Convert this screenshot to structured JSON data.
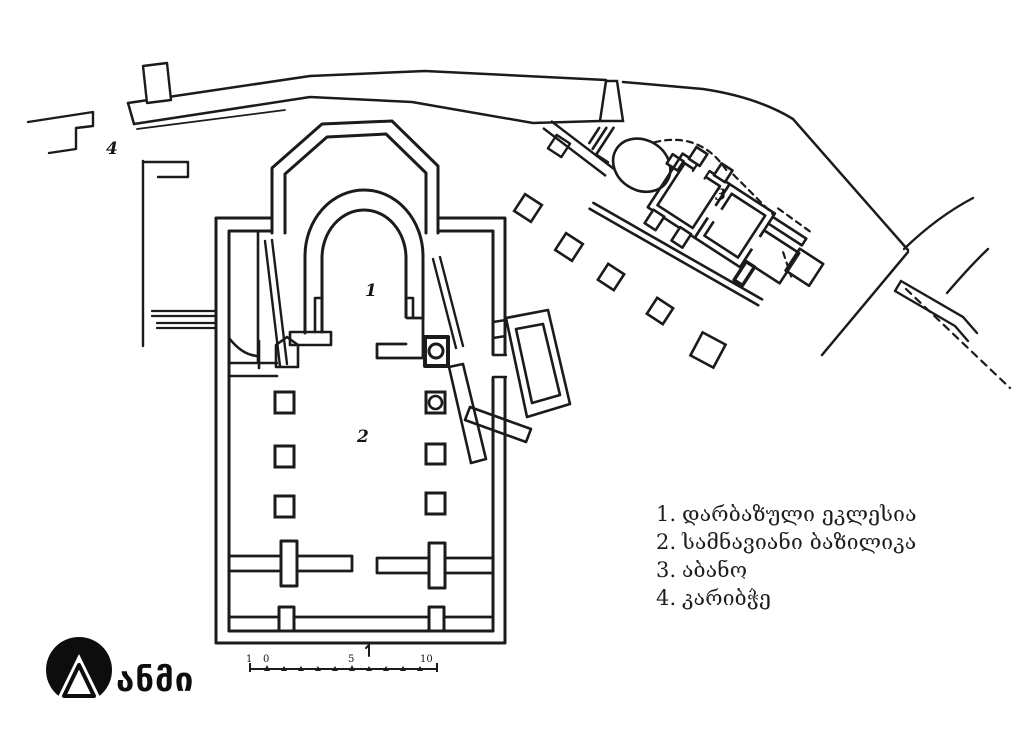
{
  "canvas": {
    "width": 1024,
    "height": 739,
    "background": "#ffffff",
    "ink": "#1b1b1b"
  },
  "legend": {
    "items": [
      {
        "num": "1.",
        "label": "დარბაზული ეკლესია"
      },
      {
        "num": "2.",
        "label": "სამნავიანი ბაზილიკა"
      },
      {
        "num": "3.",
        "label": "აბანო"
      },
      {
        "num": "4.",
        "label": "კარიბჭე"
      }
    ]
  },
  "plan_labels": {
    "hall_church": "1",
    "basilica": "2",
    "bath": "3",
    "gate": "4"
  },
  "scale_bar": {
    "ticks": [
      "1",
      "0",
      "5",
      "10"
    ]
  },
  "logo": {
    "text": "ანმი",
    "icon": "triangle-in-circle-icon"
  }
}
